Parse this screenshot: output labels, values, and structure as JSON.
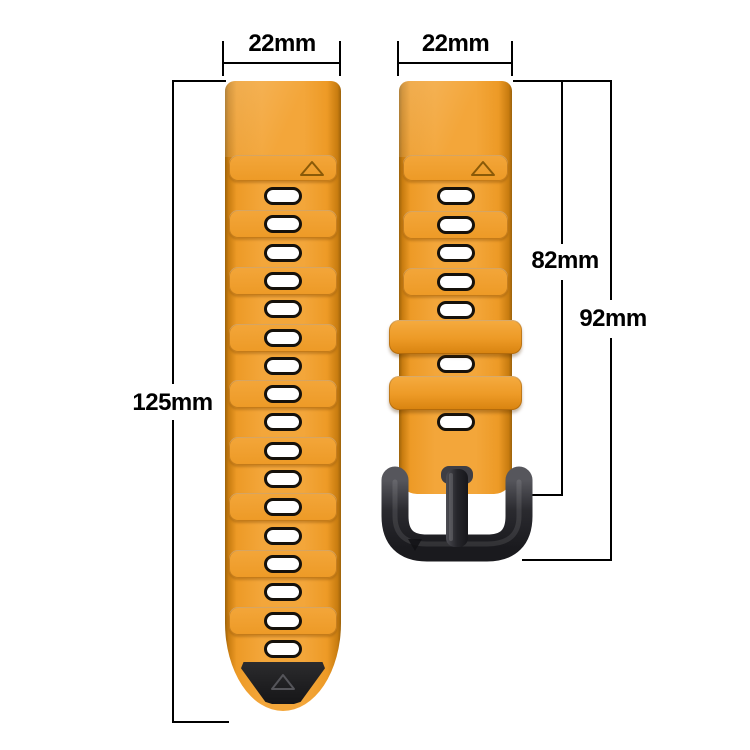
{
  "diagram": {
    "kind": "watch strap dimension diagram",
    "background": "#FFFFFF"
  },
  "measurements": {
    "left_strap_width": "22mm",
    "right_strap_width": "22mm",
    "left_strap_length": "125mm",
    "right_strap_length_to_buckle": "82mm",
    "right_strap_length_total": "92mm"
  },
  "straps": {
    "left": {
      "hole_count": 17,
      "has_end_cap": true,
      "top_triangle_mark": "up",
      "end_cap_triangle_mark": "up"
    },
    "right": {
      "hole_count": 7,
      "keeper_count": 2,
      "has_buckle": true,
      "top_triangle_mark": "up",
      "buckle_triangle_mark": "down"
    }
  },
  "colors": {
    "background": "#FFFFFF",
    "line": "#000000",
    "orange_main": "#ED9A26",
    "orange_light": "#F3A63A",
    "orange_dark": "#A96A0A",
    "hole_fill": "#FFFFFF",
    "hole_border": "#15110B",
    "cap": "#1E1E20",
    "buckle_dark": "#2A2A2F",
    "buckle_light": "#5A5A60"
  }
}
